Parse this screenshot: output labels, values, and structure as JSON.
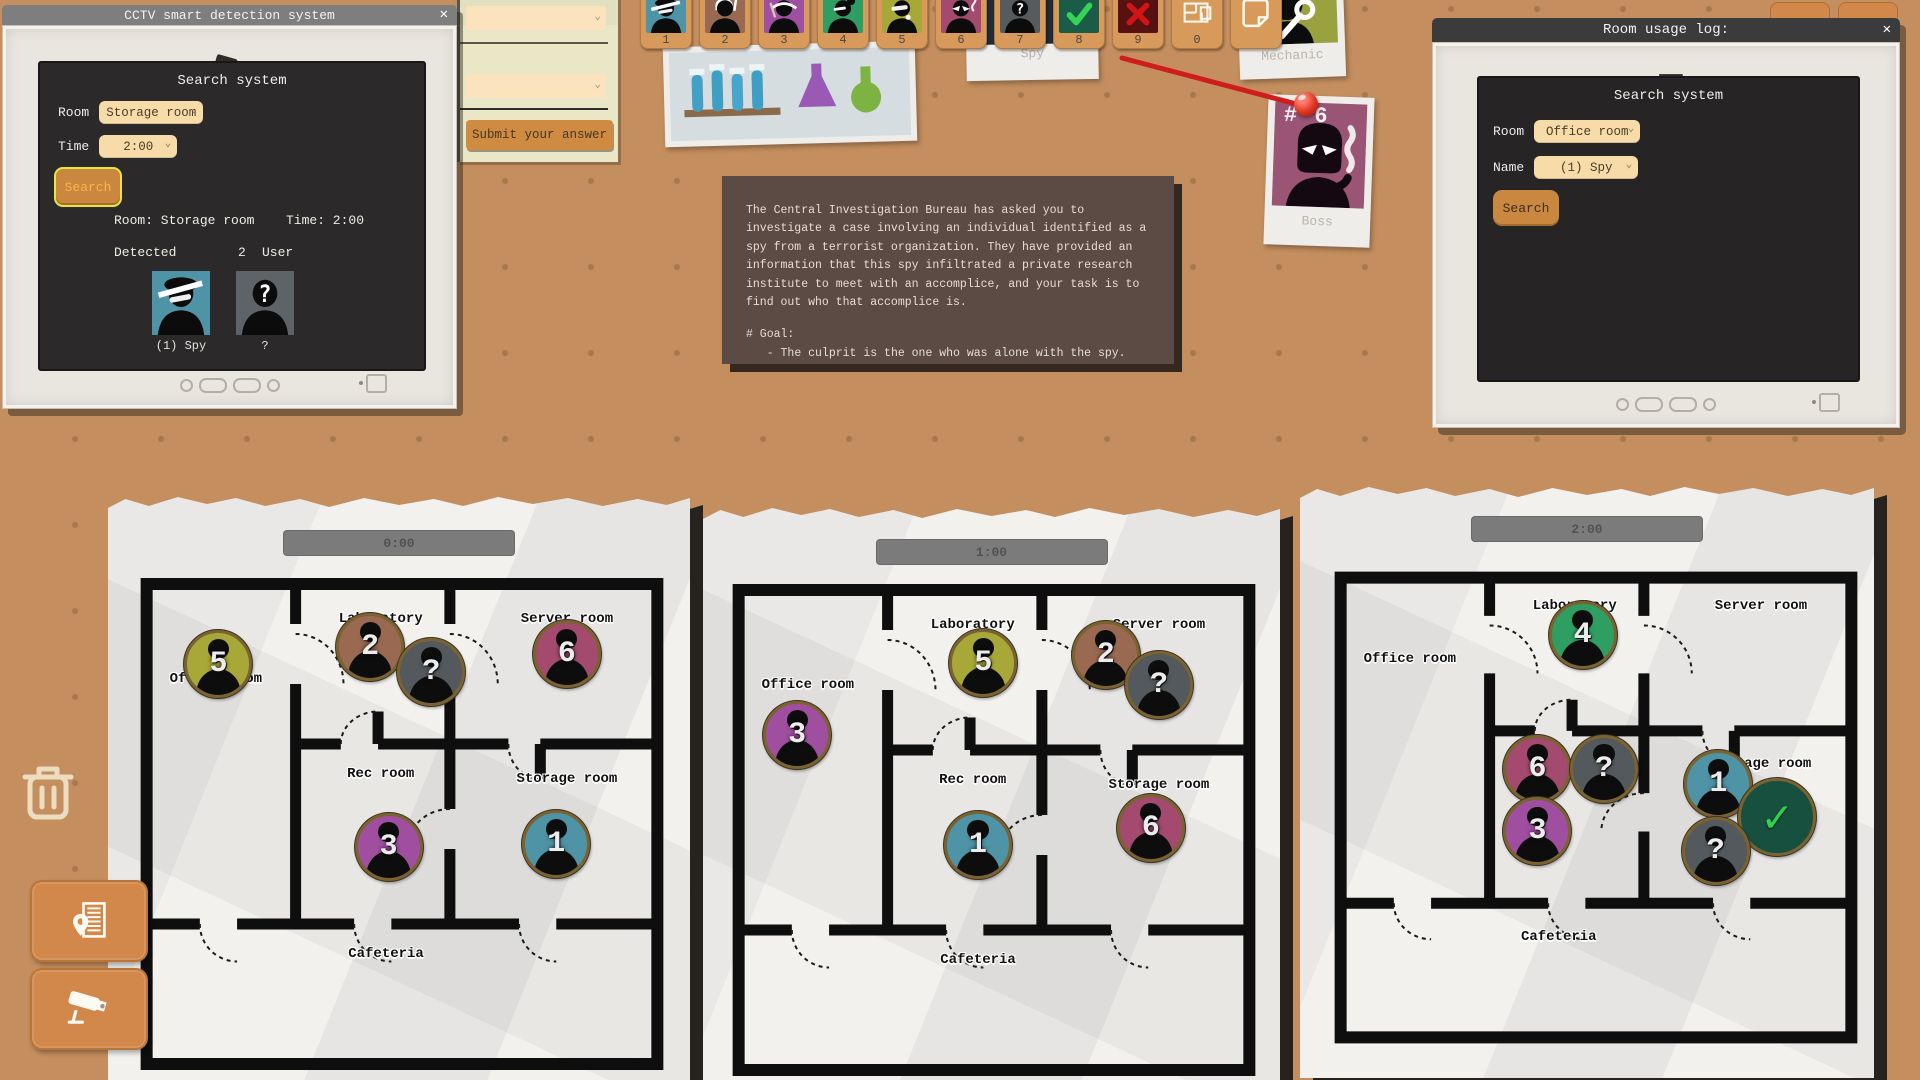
{
  "cctv_window": {
    "title": "CCTV smart detection system",
    "close": "✕",
    "heading": "Search system",
    "room_label": "Room",
    "room_value": "Storage room",
    "time_label": "Time",
    "time_value": "2:00",
    "search_label": "Search",
    "result_room": "Room: Storage room",
    "result_time": "Time: 2:00",
    "detected_label": "Detected",
    "detected_count": "2",
    "detected_unit": "User",
    "card_spy_label": "(1) Spy",
    "card_unknown_label": "?"
  },
  "room_log_window": {
    "title": "Room usage log:",
    "close": "✕",
    "heading": "Search system",
    "room_label": "Room",
    "room_value": "Office room",
    "name_label": "Name",
    "name_value": "(1) Spy",
    "search_label": "Search"
  },
  "notepad": {
    "submit_label": "Submit your answer"
  },
  "briefing": {
    "body": "The Central Investigation Bureau has asked you to investigate a case involving an individual identified as a spy from a terrorist organization. They have provided an information that this spy infiltrated a private research institute to meet with an accomplice, and your task is to find out who that accomplice is.",
    "goal_heading": "# Goal:",
    "goal_item": "   - The culprit is the one who was alone with the spy."
  },
  "suspect_bar": {
    "tiles": [
      {
        "label": "1",
        "portrait": "spy",
        "color": "#4f93a6"
      },
      {
        "label": "2",
        "portrait": "chef",
        "color": "#9a6952"
      },
      {
        "label": "3",
        "portrait": "maid",
        "color": "#a04fa0"
      },
      {
        "label": "4",
        "portrait": "researcher",
        "color": "#2f9e62"
      },
      {
        "label": "5",
        "portrait": "reporter",
        "color": "#a8a838"
      },
      {
        "label": "6",
        "portrait": "boss",
        "color": "#a34a6e"
      },
      {
        "label": "7",
        "portrait": "unknown",
        "color": "#585b5d"
      },
      {
        "label": "8",
        "portrait": "check",
        "color": "#1a5c48"
      },
      {
        "label": "9",
        "portrait": "cross",
        "color": "#571111"
      },
      {
        "label": "0",
        "portrait": "floor-plan",
        "color": ""
      },
      {
        "label": "",
        "portrait": "note",
        "color": ""
      }
    ]
  },
  "polaroids": {
    "spy_label": "Spy",
    "mechanic_label": "Mechanic",
    "boss_number": "# 6",
    "boss_label": "Boss"
  },
  "rooms": {
    "office": "Office room",
    "laboratory": "Laboratory",
    "server": "Server room",
    "rec": "Rec room",
    "storage": "Storage room",
    "cafeteria": "Cafeteria"
  },
  "floorplans": [
    {
      "time": "0:00",
      "tokens": [
        {
          "num": "5",
          "room": "Office room"
        },
        {
          "num": "2",
          "room": "Laboratory"
        },
        {
          "num": "?",
          "room": "Laboratory"
        },
        {
          "num": "6",
          "room": "Server room"
        },
        {
          "num": "3",
          "room": "Rec room"
        },
        {
          "num": "1",
          "room": "Storage room"
        }
      ]
    },
    {
      "time": "1:00",
      "tokens": [
        {
          "num": "3",
          "room": "Office room"
        },
        {
          "num": "5",
          "room": "Laboratory"
        },
        {
          "num": "2",
          "room": "Server room"
        },
        {
          "num": "?",
          "room": "Server room"
        },
        {
          "num": "1",
          "room": "Rec room"
        },
        {
          "num": "6",
          "room": "Storage room"
        }
      ]
    },
    {
      "time": "2:00",
      "tokens": [
        {
          "num": "4",
          "room": "Laboratory"
        },
        {
          "num": "6",
          "room": "Rec room"
        },
        {
          "num": "?",
          "room": "Rec room"
        },
        {
          "num": "3",
          "room": "Rec room"
        },
        {
          "num": "1",
          "room": "Storage room"
        },
        {
          "num": "✓",
          "room": "Storage room",
          "kind": "verified"
        },
        {
          "num": "?",
          "room": "Storage room"
        }
      ]
    }
  ],
  "colors": {
    "background": "#c48e5e",
    "peg_dot": "#a6794c",
    "accent_orange": "#d2884a",
    "tile_orange": "#d89a5a",
    "dropdown_cream": "#f7dca9",
    "screen_dark": "#2b2929",
    "briefing_bg": "#5c4a44",
    "paper": "#f2f1ee",
    "highlight_yellow": "#e9e43e",
    "check_green": "#2fd14f",
    "reject_red": "#cf1d1d",
    "string_red": "#cf1d1d"
  }
}
